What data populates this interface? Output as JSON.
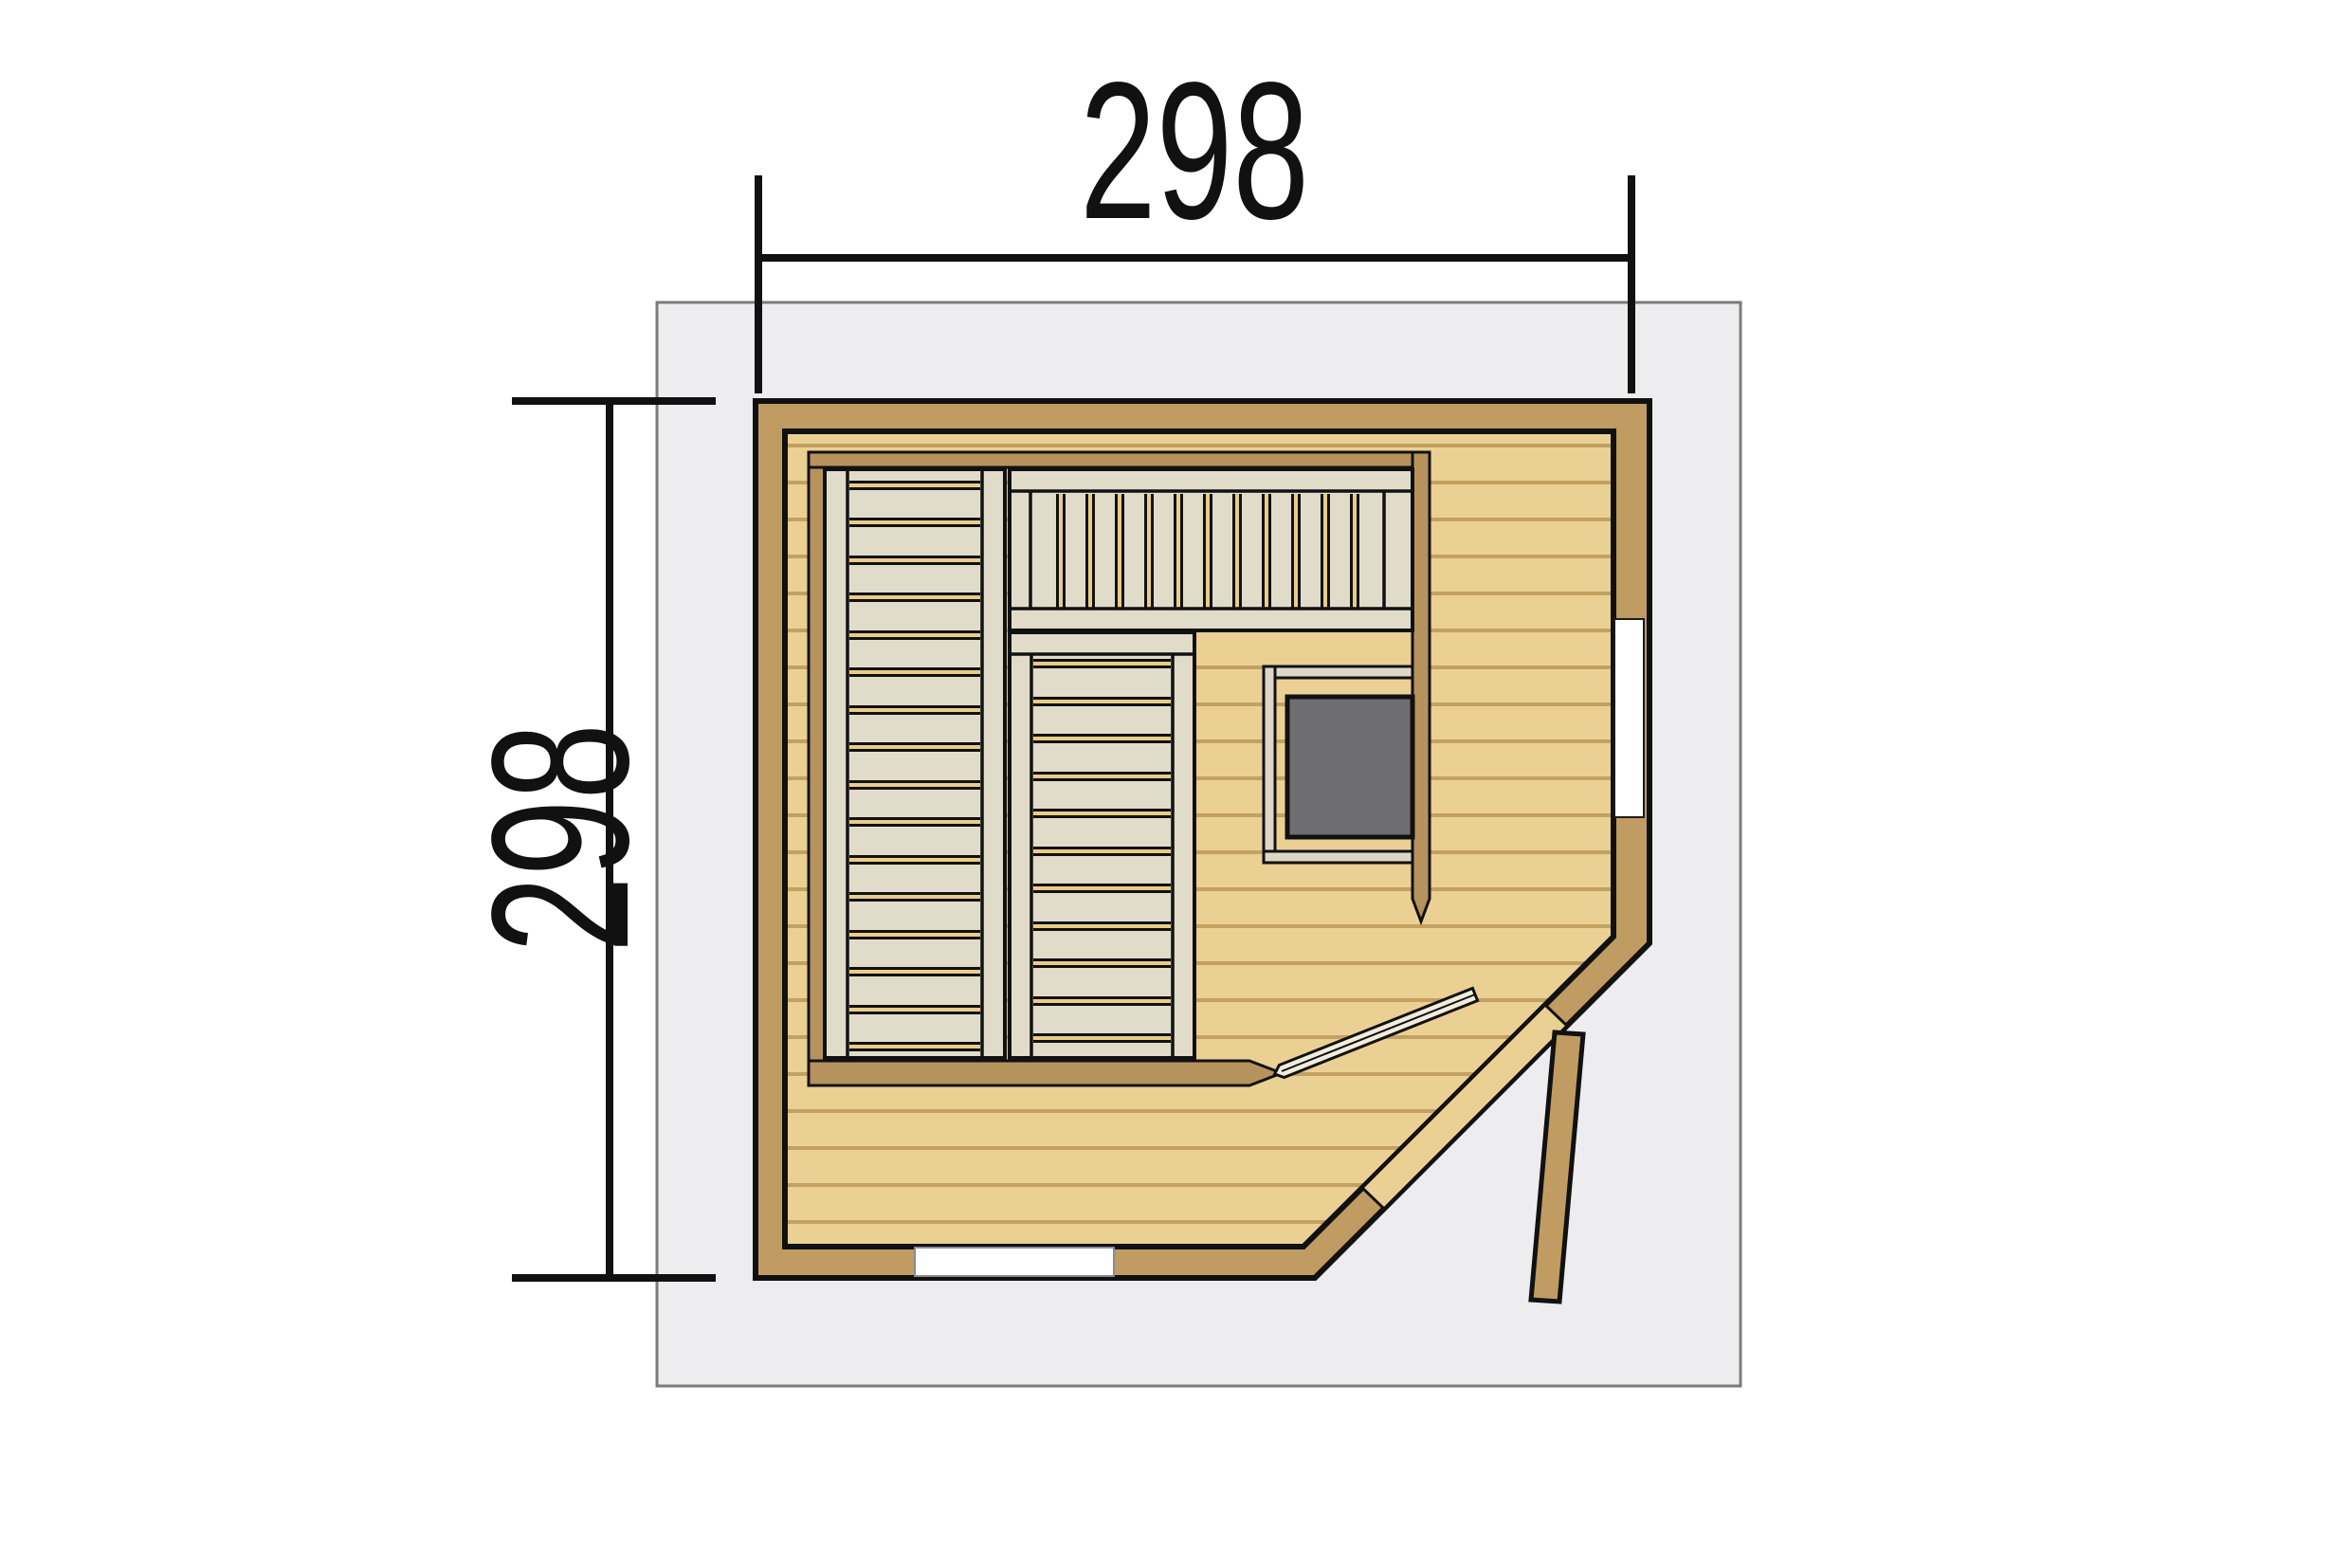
{
  "labels": {
    "width": "298",
    "height": "298"
  },
  "colors": {
    "background": "#ffffff",
    "roof_fill": "#ededef",
    "roof_border": "#7b7b7b",
    "wall": "#c09c62",
    "frame": "#b6935d",
    "floor": "#ebd093",
    "plank_line": "#c2a161",
    "bench": "#e1dcca",
    "slat_gap": "#e9cd86",
    "guard": "#dcd7c7",
    "stove": "#6e6e70",
    "outline": "#111111",
    "dim_color": "#111111",
    "window_fill": "#ffffff"
  }
}
